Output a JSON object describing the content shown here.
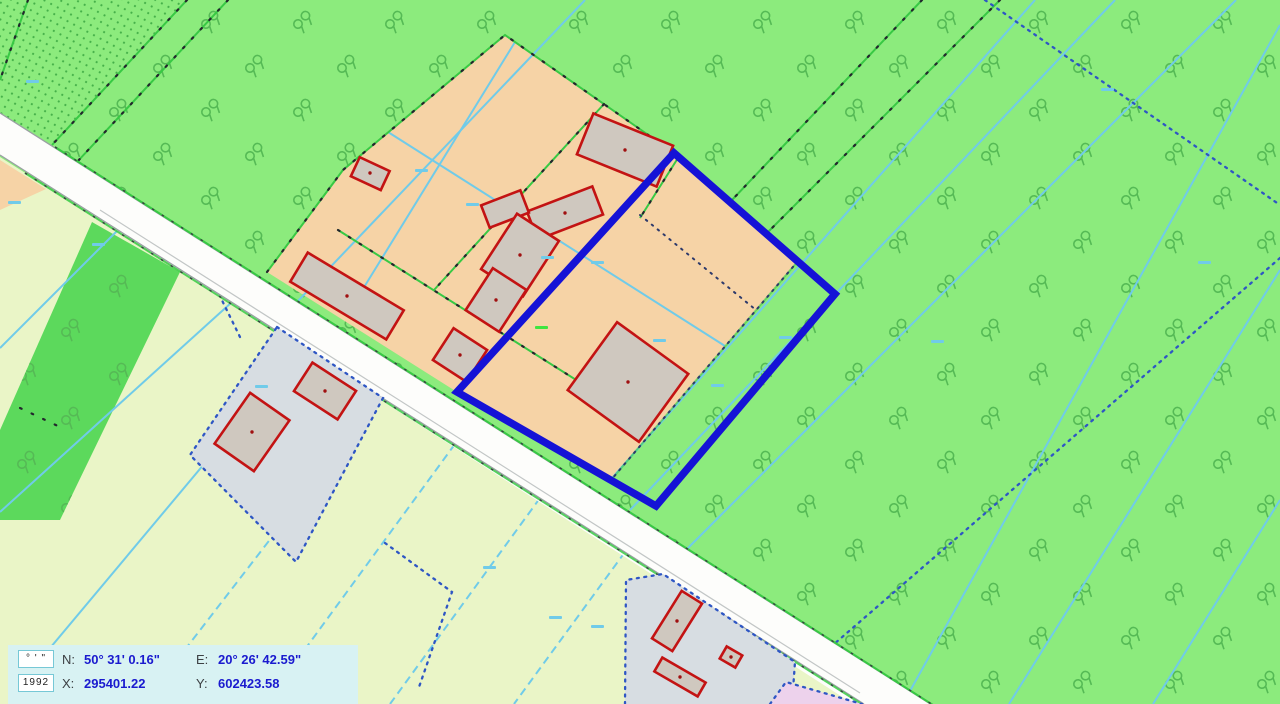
{
  "map": {
    "type": "cadastral-map-view",
    "crs": "PUWG 1992",
    "legend_semantics": {
      "meadow_green": "meadow / grassland with vegetation symbols",
      "farmland_orange": "farmstead / arable parcels",
      "parcel_gray": "built-up residential parcels",
      "residential_pink": "other built-up area",
      "selection_blue": "selected parcel outline",
      "water_cyan": "drainage ditch lines",
      "cadastral_blue": "cadastral parcel boundary (dotted)",
      "boundary_green": "land-use boundary with survey points"
    }
  },
  "coordinate_panel": {
    "unit_box_label": "° ' \"",
    "crs_box_label": "1992",
    "lat_label": "N:",
    "lat_value": "50° 31' 0.16\"",
    "lon_label": "E:",
    "lon_value": "20° 26' 42.59\"",
    "x_label": "X:",
    "x_value": "295401.22",
    "y_label": "Y:",
    "y_value": "602423.58"
  },
  "colors": {
    "selection_blue": "#1512D6",
    "meadow_green": "#8CEB7D",
    "meadow_symbol": "#55BA55",
    "dense_green": "#5CD95C",
    "dot_texture": "#45B049",
    "farmland_orange": "#F6D3A6",
    "field_yellow": "#EAF5C7",
    "parcel_gray": "#D7DDE2",
    "building_fill": "#CFC8BF",
    "building_red": "#C31313",
    "road_white": "#FDFDFB",
    "water_cyan": "#70CBE9",
    "cadastral_blue": "#2E56C4",
    "residential_pink": "#EDD2EC",
    "panel_bg": "#D8F2F3",
    "panel_value_blue": "#1A1ACF"
  }
}
